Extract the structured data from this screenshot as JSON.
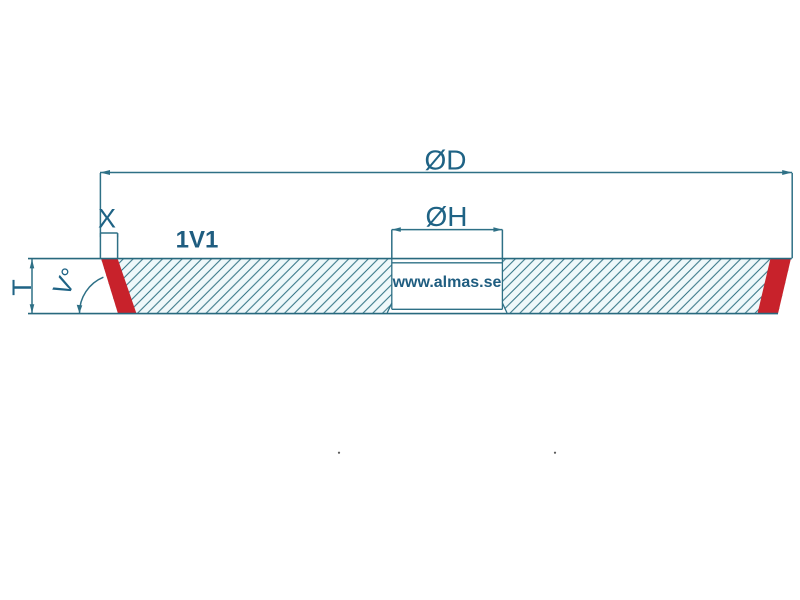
{
  "labels": {
    "outer_diameter": "ØD",
    "hole_diameter": "ØH",
    "segment_depth": "X",
    "thickness": "T",
    "bevel_angle": "V°",
    "wheel_type": "1V1",
    "watermark": "www.almas.se"
  },
  "colors": {
    "line": "#2e7086",
    "text": "#1f6385",
    "abrasive_red": "#c8222b",
    "hatch_line": "#2f7182",
    "hatch_fill": "#eff8fa",
    "background": "#ffffff"
  }
}
